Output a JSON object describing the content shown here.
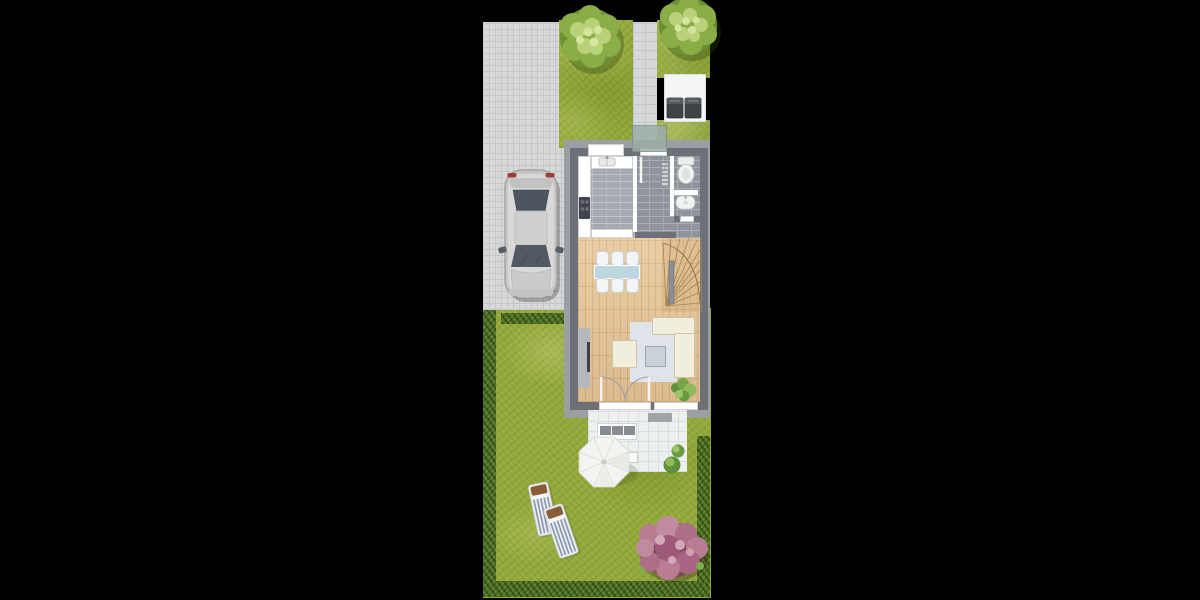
{
  "scene": {
    "type": "floor-plan-top-view",
    "background": "#000000"
  },
  "colors": {
    "bg": "#000000",
    "lawn": "#93a839",
    "hedge": "#4e7022",
    "paving": "#d7d8da",
    "pavingLine": "#c5c6c8",
    "apron": "#9b9ea2",
    "wall": "#6d7076",
    "brick": "#8f949c",
    "brickJoint": "#aab0b7",
    "kitchenBrick": "#a6aab0",
    "wood": "#e3c49a",
    "woodJoint": "#d0ad80",
    "rug": "#dee4e9",
    "sofa": "#f2eedd",
    "sofaLine": "#cfc5a5",
    "glassTable": "#bdd7e1",
    "chair": "#f3f5f6",
    "coffeeTable": "#c9d2d8",
    "tvBoard": "#b4b7bb",
    "tvDark": "#3d4145",
    "terrace": "#eef0f0",
    "terraceLine": "#dadedf",
    "mat": "#a0a4a8",
    "canopy": "#9bada8",
    "binPad": "#f4f5f5",
    "bin": "#3f4347",
    "carBody": "#c7c8c6",
    "carGlass": "#4e5560",
    "treeDark": "#6c8f34",
    "treeMid": "#8aad48",
    "treeLight": "#b9d279",
    "treeHi": "#d6e59e",
    "shrubPink": "#b97c93",
    "shrubDark": "#8a4a63",
    "parasol": "#f3f3f1",
    "loungerStripe": "#8496ad",
    "loungerWood": "#8a5c36",
    "fixture": "#f2f3f3"
  },
  "objects": {
    "driveway": "paved driveway",
    "parking": "parking pad with car",
    "car": "parked car (top view)",
    "walkway": "entrance walkway",
    "frontGarden": "front garden strip",
    "treeLeft": "deciduous tree",
    "treeRight": "deciduous tree",
    "binPad": "waste bin pad",
    "bin1": "waste bin",
    "bin2": "waste bin",
    "canopy": "entrance canopy",
    "kitchen": "kitchen with counter, sink and cooktop",
    "hall": "entrance hall",
    "wc": "guest WC with toilet and washbasin",
    "livingRoom": "living / dining room",
    "stairs": "winder staircase",
    "diningSet": "dining table with six chairs",
    "sofa": "L-shaped sofa",
    "armchair": "armchair",
    "coffeeTable": "coffee table",
    "rug": "rug",
    "tvBoard": "TV lowboard",
    "plant": "indoor plant",
    "terrace": "tiled terrace",
    "bench": "garden bench",
    "sideTable": "terrace side table",
    "parasol": "parasol",
    "terraceBushes": "potted bushes",
    "lawn": "garden lawn",
    "hedges": "hedge borders",
    "lounger1": "sun lounger",
    "lounger2": "sun lounger",
    "shrub": "flowering shrub"
  }
}
